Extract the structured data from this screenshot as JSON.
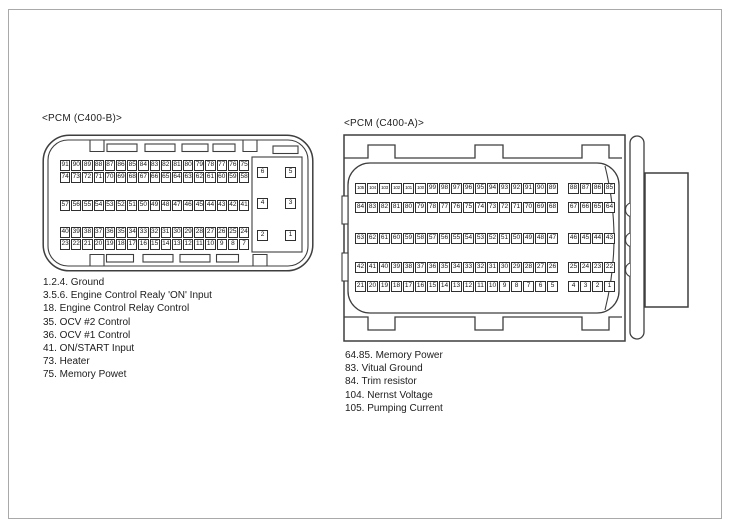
{
  "diagram": {
    "left_connector": {
      "title": "<PCM (C400-B)>",
      "pin_rows": [
        [
          91,
          90,
          89,
          88,
          87,
          86,
          85,
          84,
          83,
          82,
          81,
          80,
          79,
          78,
          77,
          76,
          75
        ],
        [
          74,
          73,
          72,
          71,
          70,
          69,
          68,
          67,
          66,
          65,
          64,
          63,
          62,
          61,
          60,
          59,
          58
        ],
        [
          57,
          56,
          55,
          54,
          53,
          52,
          51,
          50,
          49,
          48,
          47,
          46,
          45,
          44,
          43,
          42,
          41
        ],
        [
          40,
          39,
          38,
          37,
          36,
          35,
          34,
          33,
          32,
          31,
          30,
          29,
          28,
          27,
          26,
          25,
          24
        ],
        [
          23,
          22,
          21,
          20,
          19,
          18,
          17,
          16,
          15,
          14,
          13,
          12,
          11,
          10,
          9,
          8,
          7
        ]
      ],
      "aux_pin_rows": [
        [
          6,
          5
        ],
        [
          4,
          3
        ],
        [
          2,
          1
        ]
      ],
      "notes": [
        "1.2.4. Ground",
        "3.5.6. Engine Control Realy 'ON' Input",
        "18. Engine Control Relay Control",
        "35. OCV #2 Control",
        "36. OCV #1 Control",
        "41. ON/START Input",
        "73. Heater",
        "75. Memory Powet"
      ]
    },
    "right_connector": {
      "title": "<PCM (C400-A)>",
      "group_sizes": [
        17,
        4
      ],
      "pin_rows": [
        [
          105,
          104,
          103,
          102,
          101,
          100,
          99,
          98,
          97,
          96,
          95,
          94,
          93,
          92,
          91,
          90,
          89,
          88,
          87,
          86,
          85
        ],
        [
          84,
          83,
          82,
          81,
          80,
          79,
          78,
          77,
          76,
          75,
          74,
          73,
          72,
          71,
          70,
          69,
          68,
          67,
          66,
          65,
          64
        ],
        [
          63,
          62,
          61,
          60,
          59,
          58,
          57,
          56,
          55,
          54,
          53,
          52,
          51,
          50,
          49,
          48,
          47,
          46,
          45,
          44,
          43
        ],
        [
          42,
          41,
          40,
          39,
          38,
          37,
          36,
          35,
          34,
          33,
          32,
          31,
          30,
          29,
          28,
          27,
          26,
          25,
          24,
          23,
          22
        ],
        [
          21,
          20,
          19,
          18,
          17,
          16,
          15,
          14,
          13,
          12,
          11,
          10,
          9,
          8,
          7,
          6,
          5,
          4,
          3,
          2,
          1
        ]
      ],
      "notes": [
        "64.85. Memory Power",
        "83. Vitual Ground",
        "84. Trim resistor",
        "104. Nernst Voltage",
        "105. Pumping Current"
      ]
    },
    "line_color": "#3e3e3e",
    "frame_color": "#a9a9a9"
  }
}
